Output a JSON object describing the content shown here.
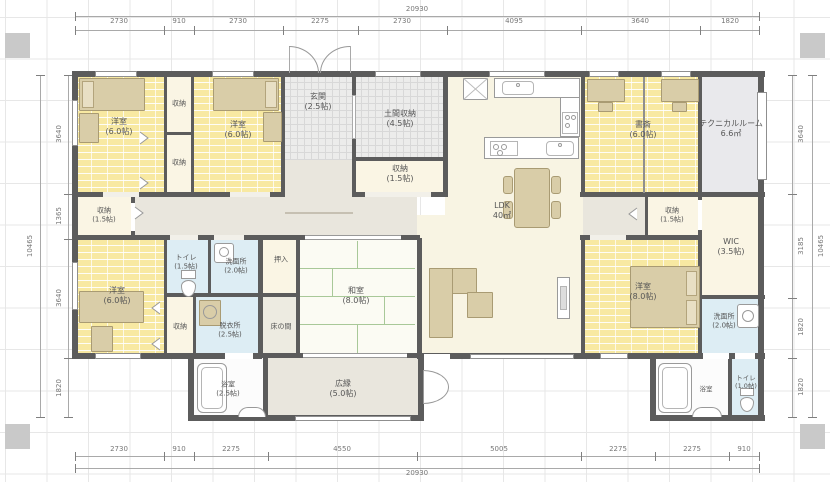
{
  "plan": {
    "type": "floor-plan",
    "rooms": {
      "yoshitsu1": {
        "label": "洋室",
        "size": "(6.0帖)"
      },
      "closet_a": {
        "label": "収納"
      },
      "closet_b": {
        "label": "収納"
      },
      "yoshitsu2": {
        "label": "洋室",
        "size": "(6.0帖)"
      },
      "genkan": {
        "label": "玄関",
        "size": "(2.5帖)"
      },
      "doma": {
        "label": "土間収納",
        "size": "(4.5帖)"
      },
      "closet_c": {
        "label": "収納",
        "size": "(1.5帖)"
      },
      "ldk": {
        "label": "LDK",
        "size": "40㎡"
      },
      "shosai": {
        "label": "書斎",
        "size": "(6.0帖)"
      },
      "technical": {
        "label": "テクニカルルーム",
        "size": "6.6㎡"
      },
      "closet_left": {
        "label": "収納",
        "size": "(1.5帖)"
      },
      "closet_right": {
        "label": "収納",
        "size": "(1.5帖)"
      },
      "wic": {
        "label": "WIC",
        "size": "(3.5帖)"
      },
      "yoshitsu3": {
        "label": "洋室",
        "size": "(6.0帖)"
      },
      "toilet1": {
        "label": "トイレ",
        "size": "(1.5帖)"
      },
      "senmen1": {
        "label": "洗面所",
        "size": "(2.0帖)"
      },
      "closet_e": {
        "label": "収納"
      },
      "datsui": {
        "label": "脱衣所",
        "size": "(2.5帖)"
      },
      "oshiire": {
        "label": "押入"
      },
      "tokonoma": {
        "label": "床の間"
      },
      "washitsu": {
        "label": "和室",
        "size": "(8.0帖)"
      },
      "bath1": {
        "label": "浴室",
        "size": "(2.5帖)"
      },
      "hiroen": {
        "label": "広縁",
        "size": "(5.0帖)"
      },
      "yoshitsu4": {
        "label": "洋室",
        "size": "(8.0帖)"
      },
      "senmen2": {
        "label": "洗面所",
        "size": "(2.0帖)"
      },
      "bath2": {
        "label": "浴室"
      },
      "toilet2": {
        "label": "トイレ",
        "size": "(1.0帖)"
      }
    },
    "dimensions": {
      "total_width": "20930",
      "total_height": "10465",
      "top": [
        "2730",
        "910",
        "2730",
        "2275",
        "2730",
        "4095",
        "3640",
        "1820"
      ],
      "bottom": [
        "2730",
        "910",
        "2275",
        "4550",
        "5005",
        "2275",
        "2275",
        "910"
      ],
      "left": [
        "3640",
        "1365",
        "3640",
        "1820"
      ],
      "right": [
        "3640",
        "3185",
        "1820",
        "1820"
      ]
    },
    "colors": {
      "wall": "#5c5c5c",
      "wood_floor": "#f8e9a2",
      "hall_floor": "#e9e6dd",
      "ldk_floor": "#f8f4e3",
      "wet_floor": "#ddedf4",
      "furniture": "#d9cda8",
      "technical_floor": "#e9e9ec"
    }
  }
}
